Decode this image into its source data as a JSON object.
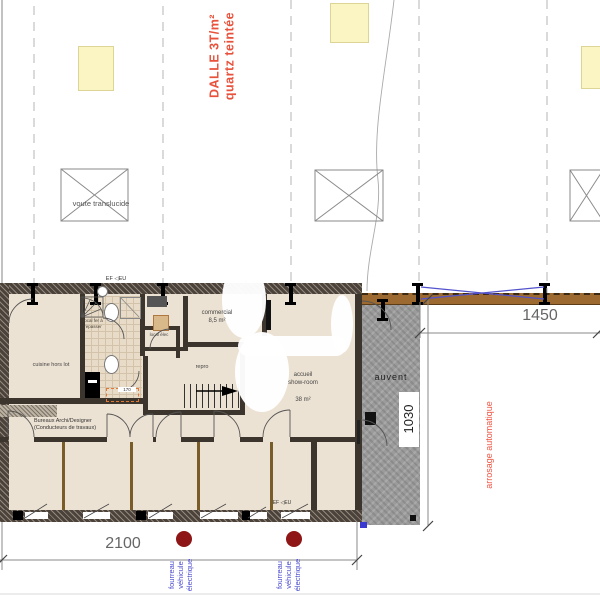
{
  "site": {
    "slab_note_line1": "DALLE 3T/m²",
    "slab_note_line2": "quartz teintée",
    "vault_label": "voute translucide"
  },
  "rooms": {
    "cuisine": "cuisine hors lot",
    "ironing_line1": "local fer à",
    "ironing_line2": "repasser",
    "local_elec": "local élec",
    "commercial_name": "commercial",
    "commercial_area": "8,5 m²",
    "repro": "repro",
    "accueil_line1": "accueil",
    "accueil_line2": "show-room",
    "accueil_area": "38 m²",
    "bureaux_line1": "Bureaux Archi/Designer",
    "bureaux_line2": "(Conducteurs de travaux)",
    "auvent": "auvent"
  },
  "annotations": {
    "ef_eu": "EF ◁EU",
    "arrosage": "arrosage automatique",
    "fourreau_line1": "fourreau",
    "fourreau_line2": "véhicule",
    "fourreau_line3": "électrique",
    "dim_170": "170"
  },
  "dimensions": {
    "bottom_width": "2100",
    "right_width": "1450",
    "auvent_depth": "1030"
  },
  "colors": {
    "note_red": "#e8523c",
    "utility_blue": "#4a4ace",
    "bollard_maroon": "#8e1616",
    "fence_brown": "#9c6a30",
    "skylight_yellow": "#faf5c2"
  }
}
